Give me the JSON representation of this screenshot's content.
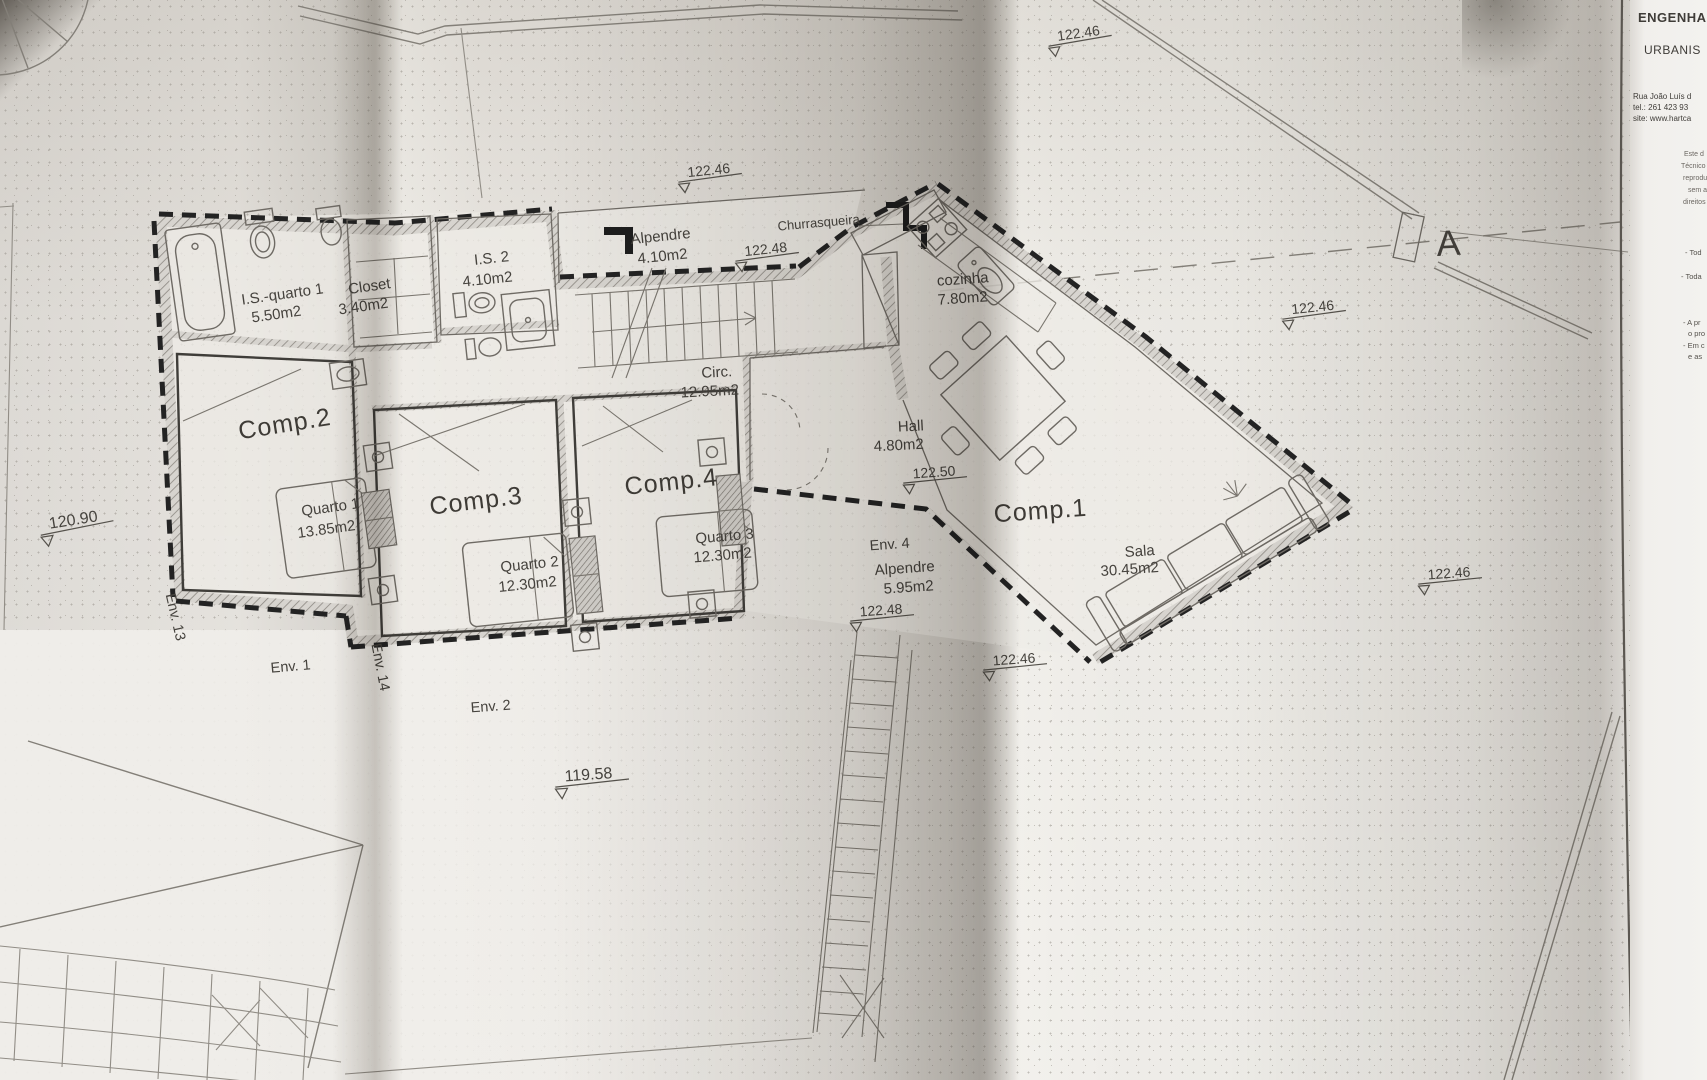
{
  "rooms": {
    "is_quarto1": {
      "name": "I.S.-quarto 1",
      "area": "5.50m2"
    },
    "closet": {
      "name": "Closet",
      "area": "3.40m2"
    },
    "is2": {
      "name": "I.S. 2",
      "area": "4.10m2"
    },
    "alpendre_top": {
      "name": "Alpendre",
      "area": "4.10m2"
    },
    "churrasqueira": {
      "name": "Churrasqueira"
    },
    "cozinha": {
      "name": "cozinha",
      "area": "7.80m2"
    },
    "circ": {
      "name": "Circ.",
      "area": "12.95m2"
    },
    "hall": {
      "name": "Hall",
      "area": "4.80m2"
    },
    "comp1": {
      "name": "Comp.1"
    },
    "sala": {
      "name": "Sala",
      "area": "30.45m2"
    },
    "comp2": {
      "name": "Comp.2"
    },
    "quarto1": {
      "name": "Quarto 1",
      "area": "13.85m2"
    },
    "comp3": {
      "name": "Comp.3"
    },
    "quarto2": {
      "name": "Quarto 2",
      "area": "12.30m2"
    },
    "comp4": {
      "name": "Comp.4"
    },
    "quarto3": {
      "name": "Quarto 3",
      "area": "12.30m2"
    },
    "env4": {
      "name": "Env. 4"
    },
    "alpendre_side": {
      "name": "Alpendre",
      "area": "5.95m2"
    }
  },
  "envelopes": {
    "env13": "Env. 13",
    "env1": "Env. 1",
    "env14": "Env. 14",
    "env2": "Env. 2"
  },
  "levels": {
    "top_center": "122.46",
    "top_right": "122.46",
    "mid_right": "122.46",
    "far_right": "122.46",
    "stair": "122.46",
    "porch_top": "122.48",
    "porch_side": "122.48",
    "hall": "122.50",
    "west": "120.90",
    "south": "119.58"
  },
  "section_marker": "A",
  "title_block": {
    "line1": "ENGENHA",
    "line2": "URBANIS",
    "address": "Rua João Luís d",
    "phone": "tel.: 261 423 93",
    "site": "site: www.hartca",
    "disclaimer": [
      "Este d",
      "Técnico",
      "reprodu",
      "sem a",
      "direitos"
    ],
    "notes": [
      "- Tod",
      "- Toda",
      "- A pr",
      "o pro",
      "- Em c",
      "e as"
    ]
  },
  "colors": {
    "paper": "#e4e1dc",
    "ink": "#45423d",
    "wall_dash": "#232323"
  }
}
